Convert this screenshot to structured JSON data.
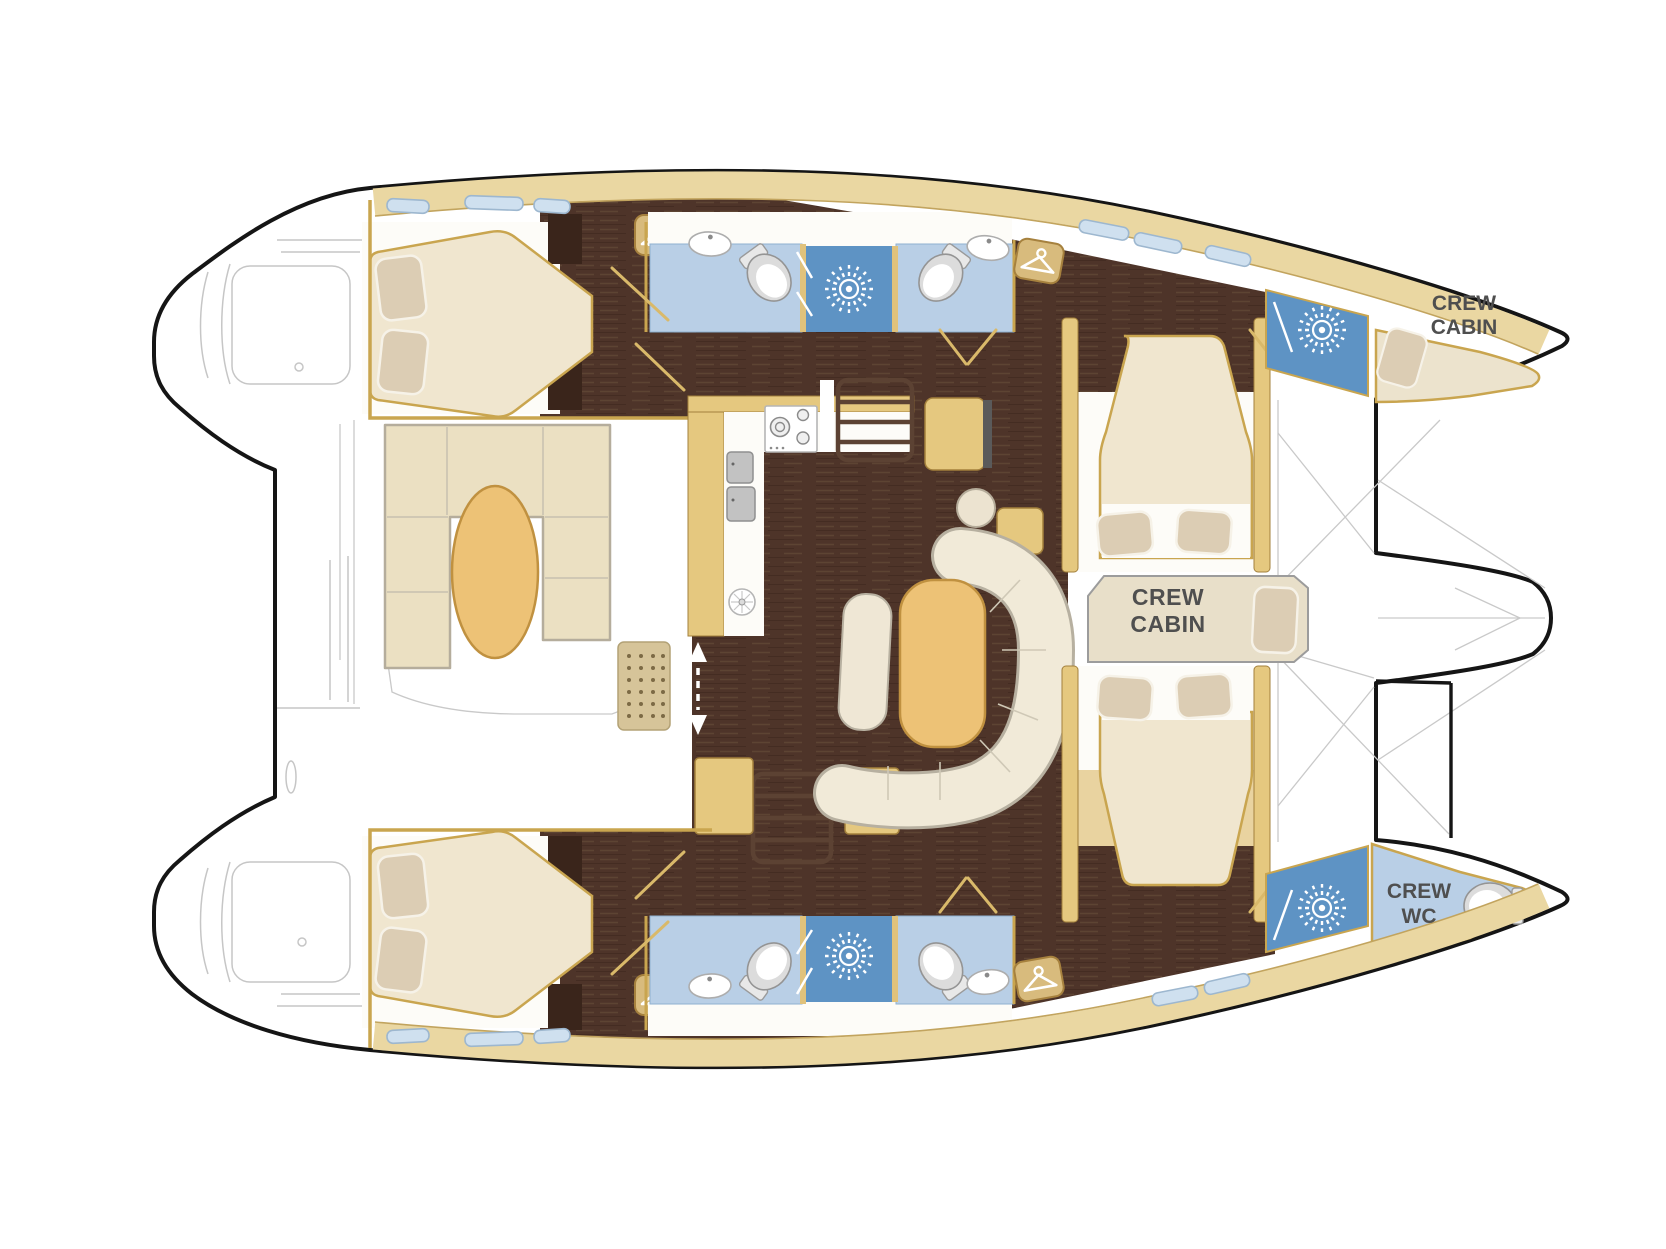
{
  "floorplan": {
    "type": "catamaran-yacht-deck-plan",
    "labels": {
      "crew_cabin_bow": {
        "line1": "CREW",
        "line2": "CABIN"
      },
      "crew_cabin_mid": {
        "line1": "CREW",
        "line2": "CABIN"
      },
      "crew_wc": {
        "line1": "CREW",
        "line2": "WC"
      }
    },
    "colors": {
      "hull_outline": "#151515",
      "sketch_gray": "#c8c8c8",
      "deck_tan": "#ead7a2",
      "wall_tan": "#e5c87f",
      "trim_tan": "#c9a54f",
      "wood_floor": "#4e3429",
      "bathroom_blue": "#b9cfe6",
      "shower_blue": "#5e93c4",
      "window_blue": "#cfe0ef",
      "mattress_cream": "#f0e6cf",
      "pillow_beige": "#dccdb4",
      "sofa_cream": "#f1ead8",
      "table_wood": "#edc276",
      "label_gray": "#4f4f4f"
    },
    "icons": [
      "shower-starburst-icon",
      "hanger-icon",
      "toilet-icon",
      "sink-icon",
      "stove-icon",
      "stairs-icon",
      "sliding-door-arrow-icon",
      "vent-grid-icon",
      "hull-window"
    ]
  }
}
